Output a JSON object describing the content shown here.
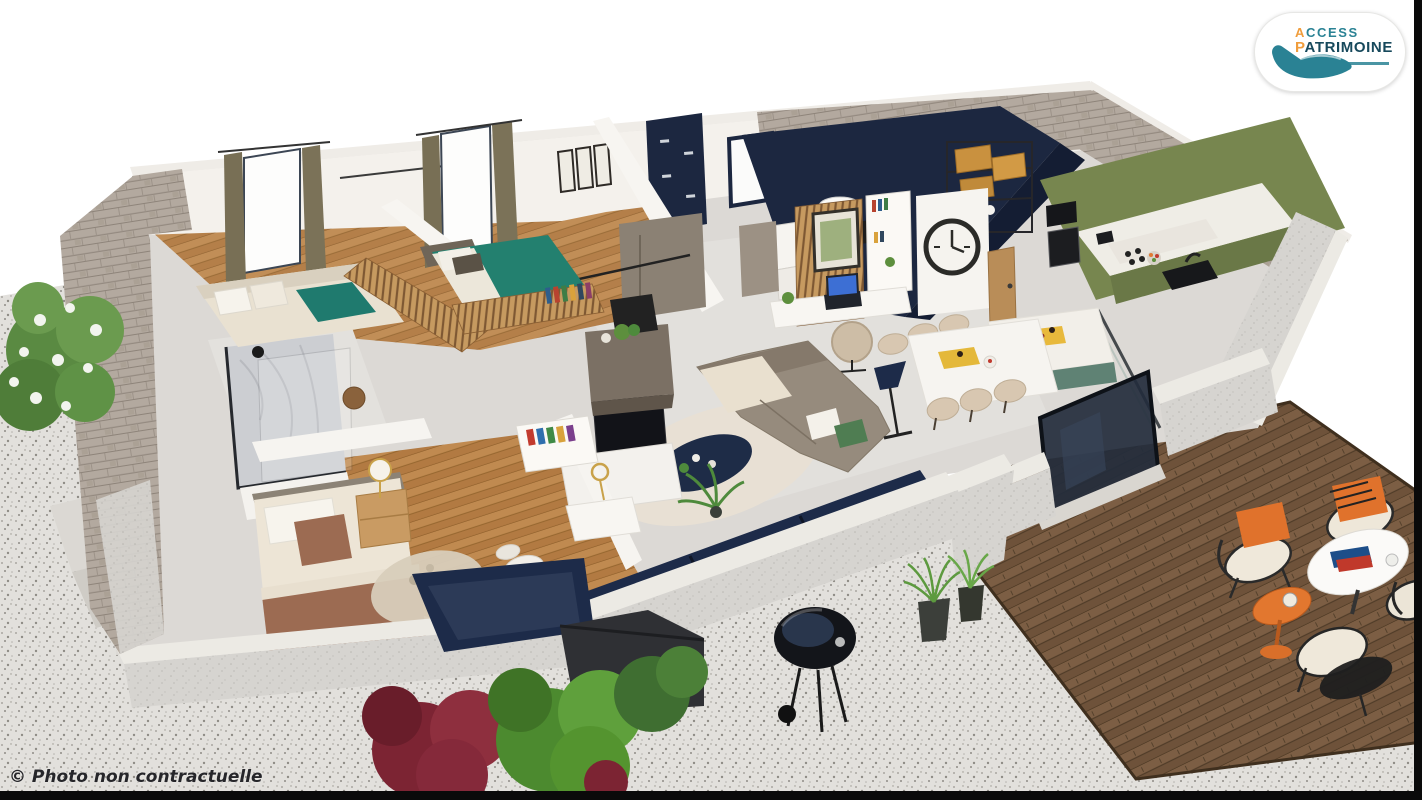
{
  "image": {
    "kind": "3d-floorplan-render",
    "width": 1422,
    "height": 800
  },
  "logo": {
    "line1": "ACCESS",
    "line2": "PATRIMOINE",
    "icon": "hand-icon"
  },
  "watermark": {
    "text": "© Photo non contractuelle"
  },
  "colors": {
    "background": "#ffffff",
    "gravel": "#e2e0dc",
    "deck_wood": "#7c5e44",
    "stone_wall": "#b3a99f",
    "concrete_wall": "#d6d4d0",
    "interior_wall": "#f4f1ec",
    "interior_floor": "#dcd9d5",
    "bedroom_floor": "#c08a50",
    "kitchen_green": "#77864f",
    "accent_navy": "#1c2740",
    "teal_bed": "#23806f",
    "sofa_taupe": "#968b7d",
    "cushion_orange": "#e0722c",
    "plant_green": "#5d8f3d",
    "bush_red": "#7c2433",
    "logo_teal": "#2a8294",
    "logo_navy": "#17495c",
    "logo_orange": "#f09d3c",
    "edge_strip": "#0a0a0a"
  }
}
